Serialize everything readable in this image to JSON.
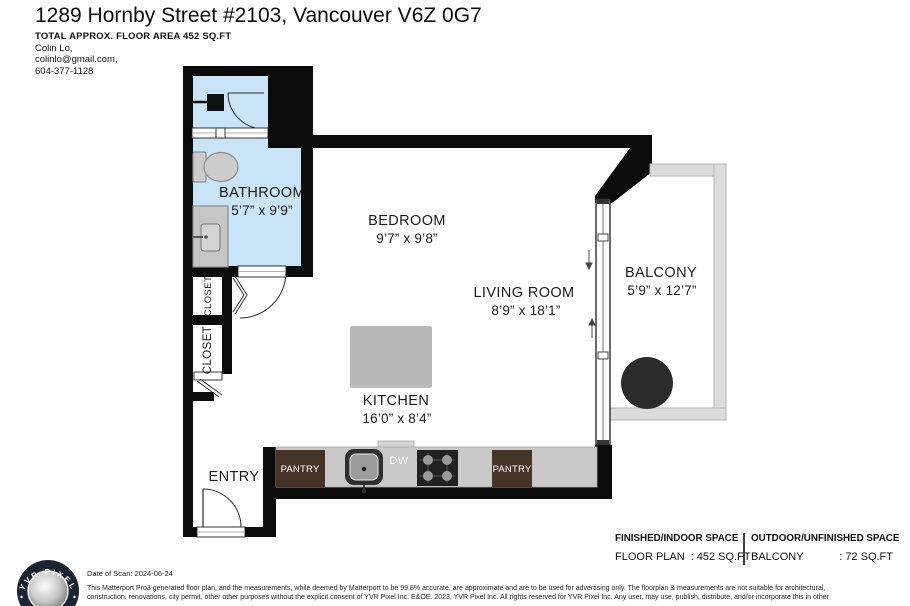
{
  "header": {
    "title": "1289 Hornby Street #2103, Vancouver V6Z 0G7",
    "subtitle": "TOTAL APPROX. FLOOR AREA 452 SQ.FT",
    "contact_name": "Colin Lo,",
    "contact_email": "colinlo@gmail.com,",
    "contact_phone": "604-377-1128"
  },
  "plan": {
    "rooms": {
      "bathroom": {
        "name": "BATHROOM",
        "dims": "5’7” x 9’9”"
      },
      "bedroom": {
        "name": "BEDROOM",
        "dims": "9’7” x 9’8”"
      },
      "living_room": {
        "name": "LIVING ROOM",
        "dims": "8’9” x 18’1”"
      },
      "balcony": {
        "name": "BALCONY",
        "dims": "5’9” x 12’7”"
      },
      "kitchen": {
        "name": "KITCHEN",
        "dims": "16’0” x 8’4”"
      },
      "entry": {
        "name": "ENTRY"
      },
      "closet_upper": {
        "name": "CLOSET"
      },
      "closet_lower": {
        "name": "CLOSET"
      }
    },
    "fixtures": {
      "pantry_left": "PANTRY",
      "pantry_right": "PANTRY",
      "dishwasher": "DW"
    },
    "colors": {
      "wall": "#0b0b0b",
      "bathroom_floor": "#c8e4f6",
      "counter": "#c9c9c9",
      "island": "#b9b9b9",
      "pantry": "#473429",
      "balcony_wall": "#dcdcdc",
      "fixture_gray": "#c6c6c6",
      "table": "#2b2b2b"
    }
  },
  "footer": {
    "indoor": {
      "header": "FINISHED/INDOOR SPACE",
      "label": "FLOOR PLAN",
      "separator": ":",
      "value": "452 SQ.FT"
    },
    "outdoor": {
      "header": "OUTDOOR/UNFINISHED SPACE",
      "label": "BALCONY",
      "separator": ":",
      "value": "72 SQ.FT"
    },
    "scan_date": "Date of Scan: 2024-06-24",
    "disclaimer_line1": "This Matterport Pro3 generated floor plan, and the measurements, while deemed by Matterport to be 99.8% accurate, are approximate and are to be used for advertising only. The floorplan & measurements are not suitable for architectural,",
    "disclaimer_line2": "construction, renovations, city permit, other other purposes without the explicit consent of YVR Pixel Inc. E&OE. 2023, YVR Pixel Inc. All rights reserved for YVR Pixel Inc. Any user, may use, publish, distribute, and/or incorporate this in other",
    "logo_text": "YVR PIXEL"
  }
}
